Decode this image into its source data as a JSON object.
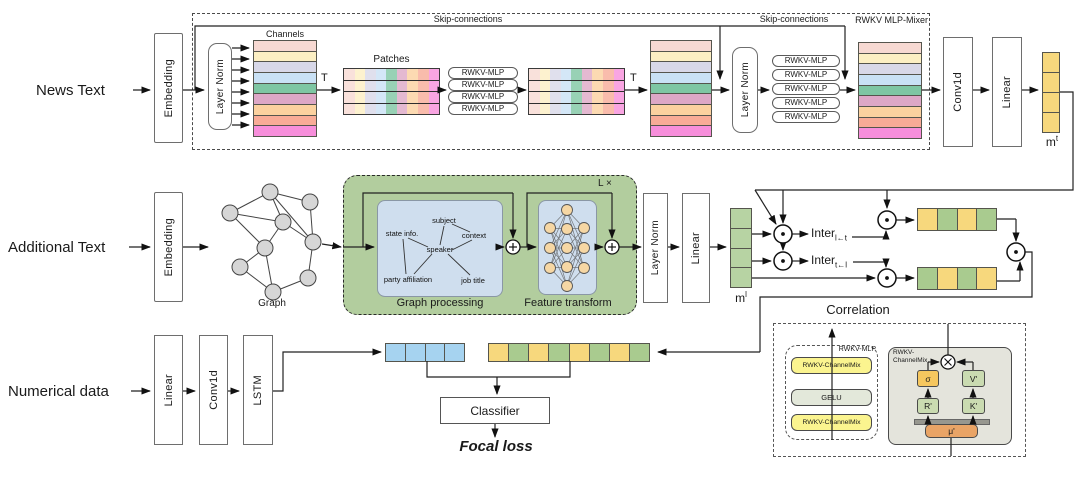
{
  "diagram": {
    "top_row": {
      "input_label": "News Text",
      "embedding": "Embedding",
      "mixer_box_label": "RWKV MLP-Mixer",
      "skip_label_1": "Skip-connections",
      "skip_label_2": "Skip-connections",
      "layer_norm_1": "Layer Norm",
      "channels_label": "Channels",
      "transpose_1": "T",
      "patches_label": "Patches",
      "rwkv_mlp": "RWKV-MLP",
      "transpose_2": "T",
      "layer_norm_2": "Layer Norm",
      "conv1d": "Conv1d",
      "linear": "Linear",
      "output_vec": {
        "base": "m",
        "sup": "t"
      }
    },
    "middle_row": {
      "input_label": "Additional Text",
      "embedding": "Embedding",
      "graph_label": "Graph",
      "block_repeat": "L ×",
      "graph_processing": {
        "title": "Graph processing",
        "words": [
          "subject",
          "state info.",
          "context",
          "speaker",
          "party affiliation",
          "job title"
        ]
      },
      "feature_transform": {
        "title": "Feature transform"
      },
      "layer_norm": "Layer Norm",
      "linear": "Linear",
      "output_vec": {
        "base": "m",
        "sup": "l"
      },
      "inter_lt": {
        "base": "Inter",
        "sub": "l←t"
      },
      "inter_tl": {
        "base": "Inter",
        "sub": "t←l"
      }
    },
    "bottom_row": {
      "input_label": "Numerical data",
      "linear": "Linear",
      "conv1d": "Conv1d",
      "lstm": "LSTM",
      "classifier": "Classifier",
      "loss": "Focal loss"
    },
    "correlation": {
      "title": "Correlation",
      "rwkv_mlp_label": "RWKV-MLP",
      "channelmix_top": "RWKV-ChannelMix",
      "gelu": "GELU",
      "channelmix_bottom": "RWKV-ChannelMix",
      "gray_label_line1": "RWKV-",
      "gray_label_line2": "ChannelMix",
      "sigma": "σ",
      "v": "V'",
      "r": "R'",
      "k": "K'",
      "mu": "μ'"
    }
  },
  "palette": {
    "channel_colors": [
      "#f7d9d2",
      "#fcefc3",
      "#d8d8e8",
      "#c9e1f5",
      "#7ec6a3",
      "#dda7c6",
      "#fbd19f",
      "#f8ab97",
      "#f78edb"
    ],
    "mt_cells": [
      "#f7d87d",
      "#f7d87d",
      "#f7d87d",
      "#f7d87d"
    ],
    "ml_cells": [
      "#b7d3a3",
      "#b7d3a3",
      "#b7d3a3",
      "#b7d3a3"
    ],
    "hstack_top": [
      "#f7d87d",
      "#a9cb8f",
      "#f7d87d",
      "#a9cb8f"
    ],
    "hstack_bottom": [
      "#a9cb8f",
      "#f7d87d",
      "#a9cb8f",
      "#f7d87d"
    ],
    "blue_cells": [
      "#a6d3f0",
      "#a6d3f0",
      "#a6d3f0",
      "#a6d3f0"
    ],
    "concat_cells": [
      "#f7d87d",
      "#a9cb8f",
      "#f7d87d",
      "#a9cb8f",
      "#f7d87d",
      "#a9cb8f",
      "#f7d87d",
      "#a9cb8f"
    ],
    "green_block": "#b2cd9e",
    "inner_blue": "#cfdeee",
    "gray_block": "#e4e4dc",
    "chmix_yellow": "#fbf48f",
    "gelu_fill": "#e3e8da",
    "sigma_fill": "#f6c75f",
    "rkv_green": "#cadbb1",
    "mu_fill": "#e9a466",
    "graph_node": "#d6d6d6",
    "nn_node": "#f6d7a4"
  }
}
